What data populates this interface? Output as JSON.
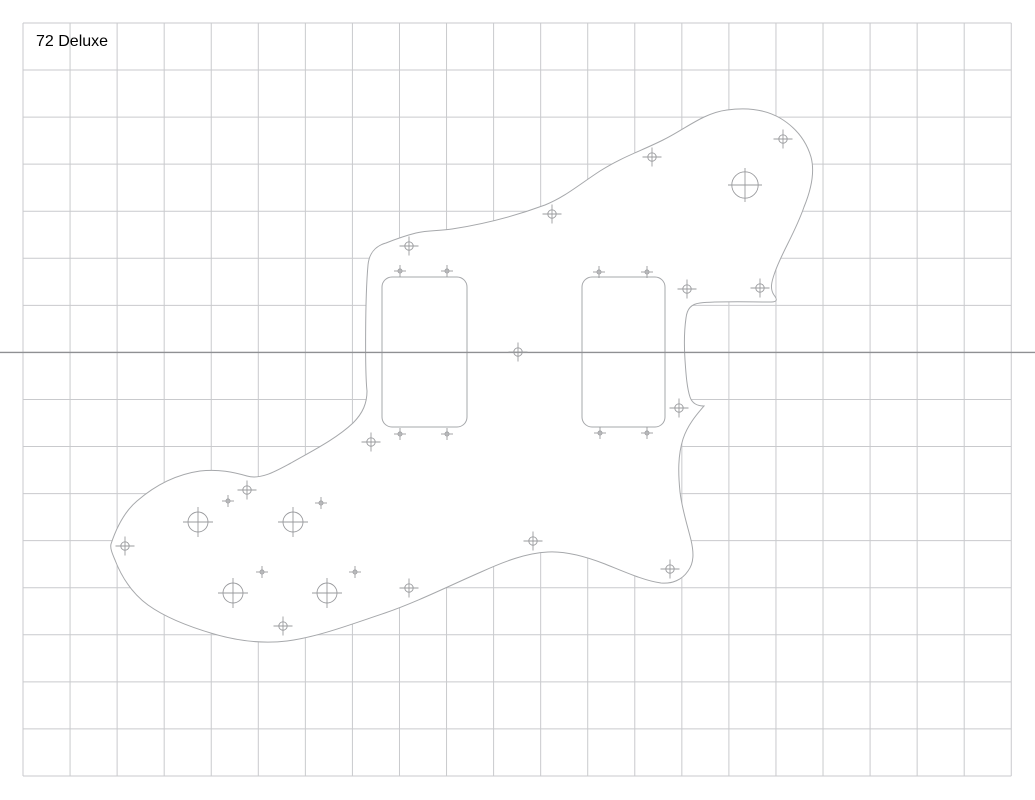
{
  "drawing": {
    "label": "72 Deluxe",
    "canvas": {
      "width": 1035,
      "height": 800
    },
    "colors": {
      "background": "#ffffff",
      "grid_line": "#c9cacd",
      "center_line": "#8f9093",
      "outline": "#a6a8ab",
      "cutout": "#a6a8ab",
      "marker": "#9a9b9e",
      "label_text": "#000000"
    },
    "grid": {
      "origin_x": 23,
      "origin_y": 23,
      "cell": 47.06,
      "cols": 21,
      "rows": 16,
      "centerline_row": 7,
      "grid_stroke_width": 1,
      "centerline_stroke_width": 1.3
    },
    "pickguard": {
      "outline_path": "M 111 544 C 116 529 124 512 137 501 C 152 488 172 475 200 471 C 219 469 233 472 247 476 C 261 480 276 471 291 463 C 312 451 336 439 353 423 C 363 413 367 403 367 391 C 365 373 365 298 368 265 C 369 254 375 246 386 243 C 396 239 404 236 416 233 C 428 230 440 231 452 229 C 478 225 510 218 545 205 C 565 197 580 184 600 171 C 622 157 641 151 663 140 C 684 130 703 113 727 110 C 748 107 766 110 780 118 C 795 127 806 140 811 157 C 815 172 811 190 804 207 C 795 233 782 252 775 272 C 771 283 770 289 774 295 C 777 299 778 302 771 302 C 748 302 718 301 700 303 C 691 304 687 309 686 318 C 684 332 684 345 685 360 C 686 375 687 388 690 397 C 692 403 697 406 704 406 C 698 413 688 424 683 439 C 678 455 678 472 680 492 C 682 509 687 524 691 540 C 694 553 694 563 688 571 C 682 580 672 584 661 583 C 645 581 625 572 605 564 C 587 557 566 551 548 552 C 527 553 505 561 481 572 C 451 585 417 602 385 613 C 352 624 318 637 287 641 C 262 644 238 641 214 634 C 190 627 166 618 148 605 C 133 594 122 578 115 560 C 112 553 110 548 111 544 Z",
      "outline_stroke_width": 1,
      "pickup_cutouts": [
        {
          "x": 382,
          "y": 277,
          "width": 85,
          "height": 150,
          "radius": 10
        },
        {
          "x": 582,
          "y": 277,
          "width": 83,
          "height": 150,
          "radius": 10
        }
      ]
    },
    "markers": {
      "stroke_width": 0.9,
      "screw_holes": {
        "circle_radius": 4.2,
        "arm_length": 9.5,
        "points": [
          [
            652,
            157
          ],
          [
            783,
            139
          ],
          [
            552,
            214
          ],
          [
            409,
            246
          ],
          [
            518,
            352
          ],
          [
            371,
            442
          ],
          [
            687,
            289
          ],
          [
            760,
            288
          ],
          [
            679,
            408
          ],
          [
            670,
            569
          ],
          [
            533,
            541
          ],
          [
            409,
            588
          ],
          [
            247,
            490
          ],
          [
            125,
            546
          ],
          [
            283,
            626
          ]
        ]
      },
      "alignment_marks": {
        "circle_radius": 2,
        "arm_length": 6,
        "points": [
          [
            400,
            271
          ],
          [
            447,
            271
          ],
          [
            400,
            434
          ],
          [
            447,
            434
          ],
          [
            599,
            272
          ],
          [
            647,
            272
          ],
          [
            600,
            433
          ],
          [
            647,
            433
          ],
          [
            228,
            501
          ],
          [
            321,
            503
          ],
          [
            262,
            572
          ],
          [
            355,
            572
          ]
        ]
      },
      "pot_holes": {
        "circle_radius": 10,
        "arm_length": 15,
        "points": [
          [
            198,
            522
          ],
          [
            293,
            522
          ],
          [
            233,
            593
          ],
          [
            327,
            593
          ]
        ]
      },
      "switch_hole": {
        "circle_radius": 13.2,
        "arm_length": 17,
        "points": [
          [
            745,
            185
          ]
        ]
      }
    }
  }
}
